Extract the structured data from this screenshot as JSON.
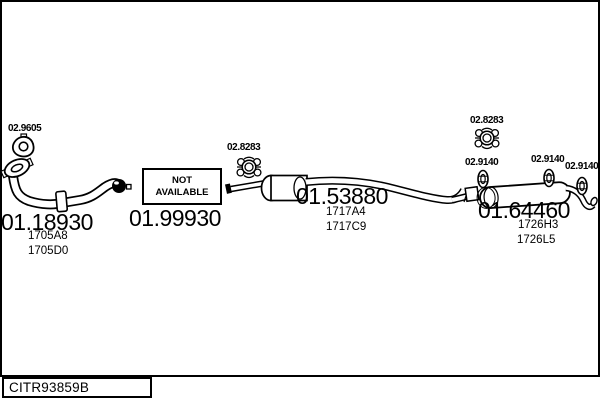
{
  "drawing": {
    "code": "CITR93859B"
  },
  "parts": {
    "front_pipe": {
      "number": "01.18930",
      "refs": [
        "1705A8",
        "1705D0"
      ]
    },
    "middle_pipe": {
      "number": "01.99930",
      "status": [
        "NOT",
        "AVAILABLE"
      ]
    },
    "center_pipe": {
      "number": "01.53880",
      "refs": [
        "1717A4",
        "1717C9"
      ]
    },
    "rear_muffler": {
      "number": "01.64460",
      "refs": [
        "1726H3",
        "1726L5"
      ]
    }
  },
  "fittings": {
    "front_gasket": "02.9605",
    "center_clamp": "02.8283",
    "rear_clamp": "02.8283",
    "hanger_1": "02.9140",
    "hanger_2": "02.9140",
    "hanger_3": "02.9140"
  },
  "colors": {
    "ink": "#000000",
    "paper": "#ffffff"
  }
}
